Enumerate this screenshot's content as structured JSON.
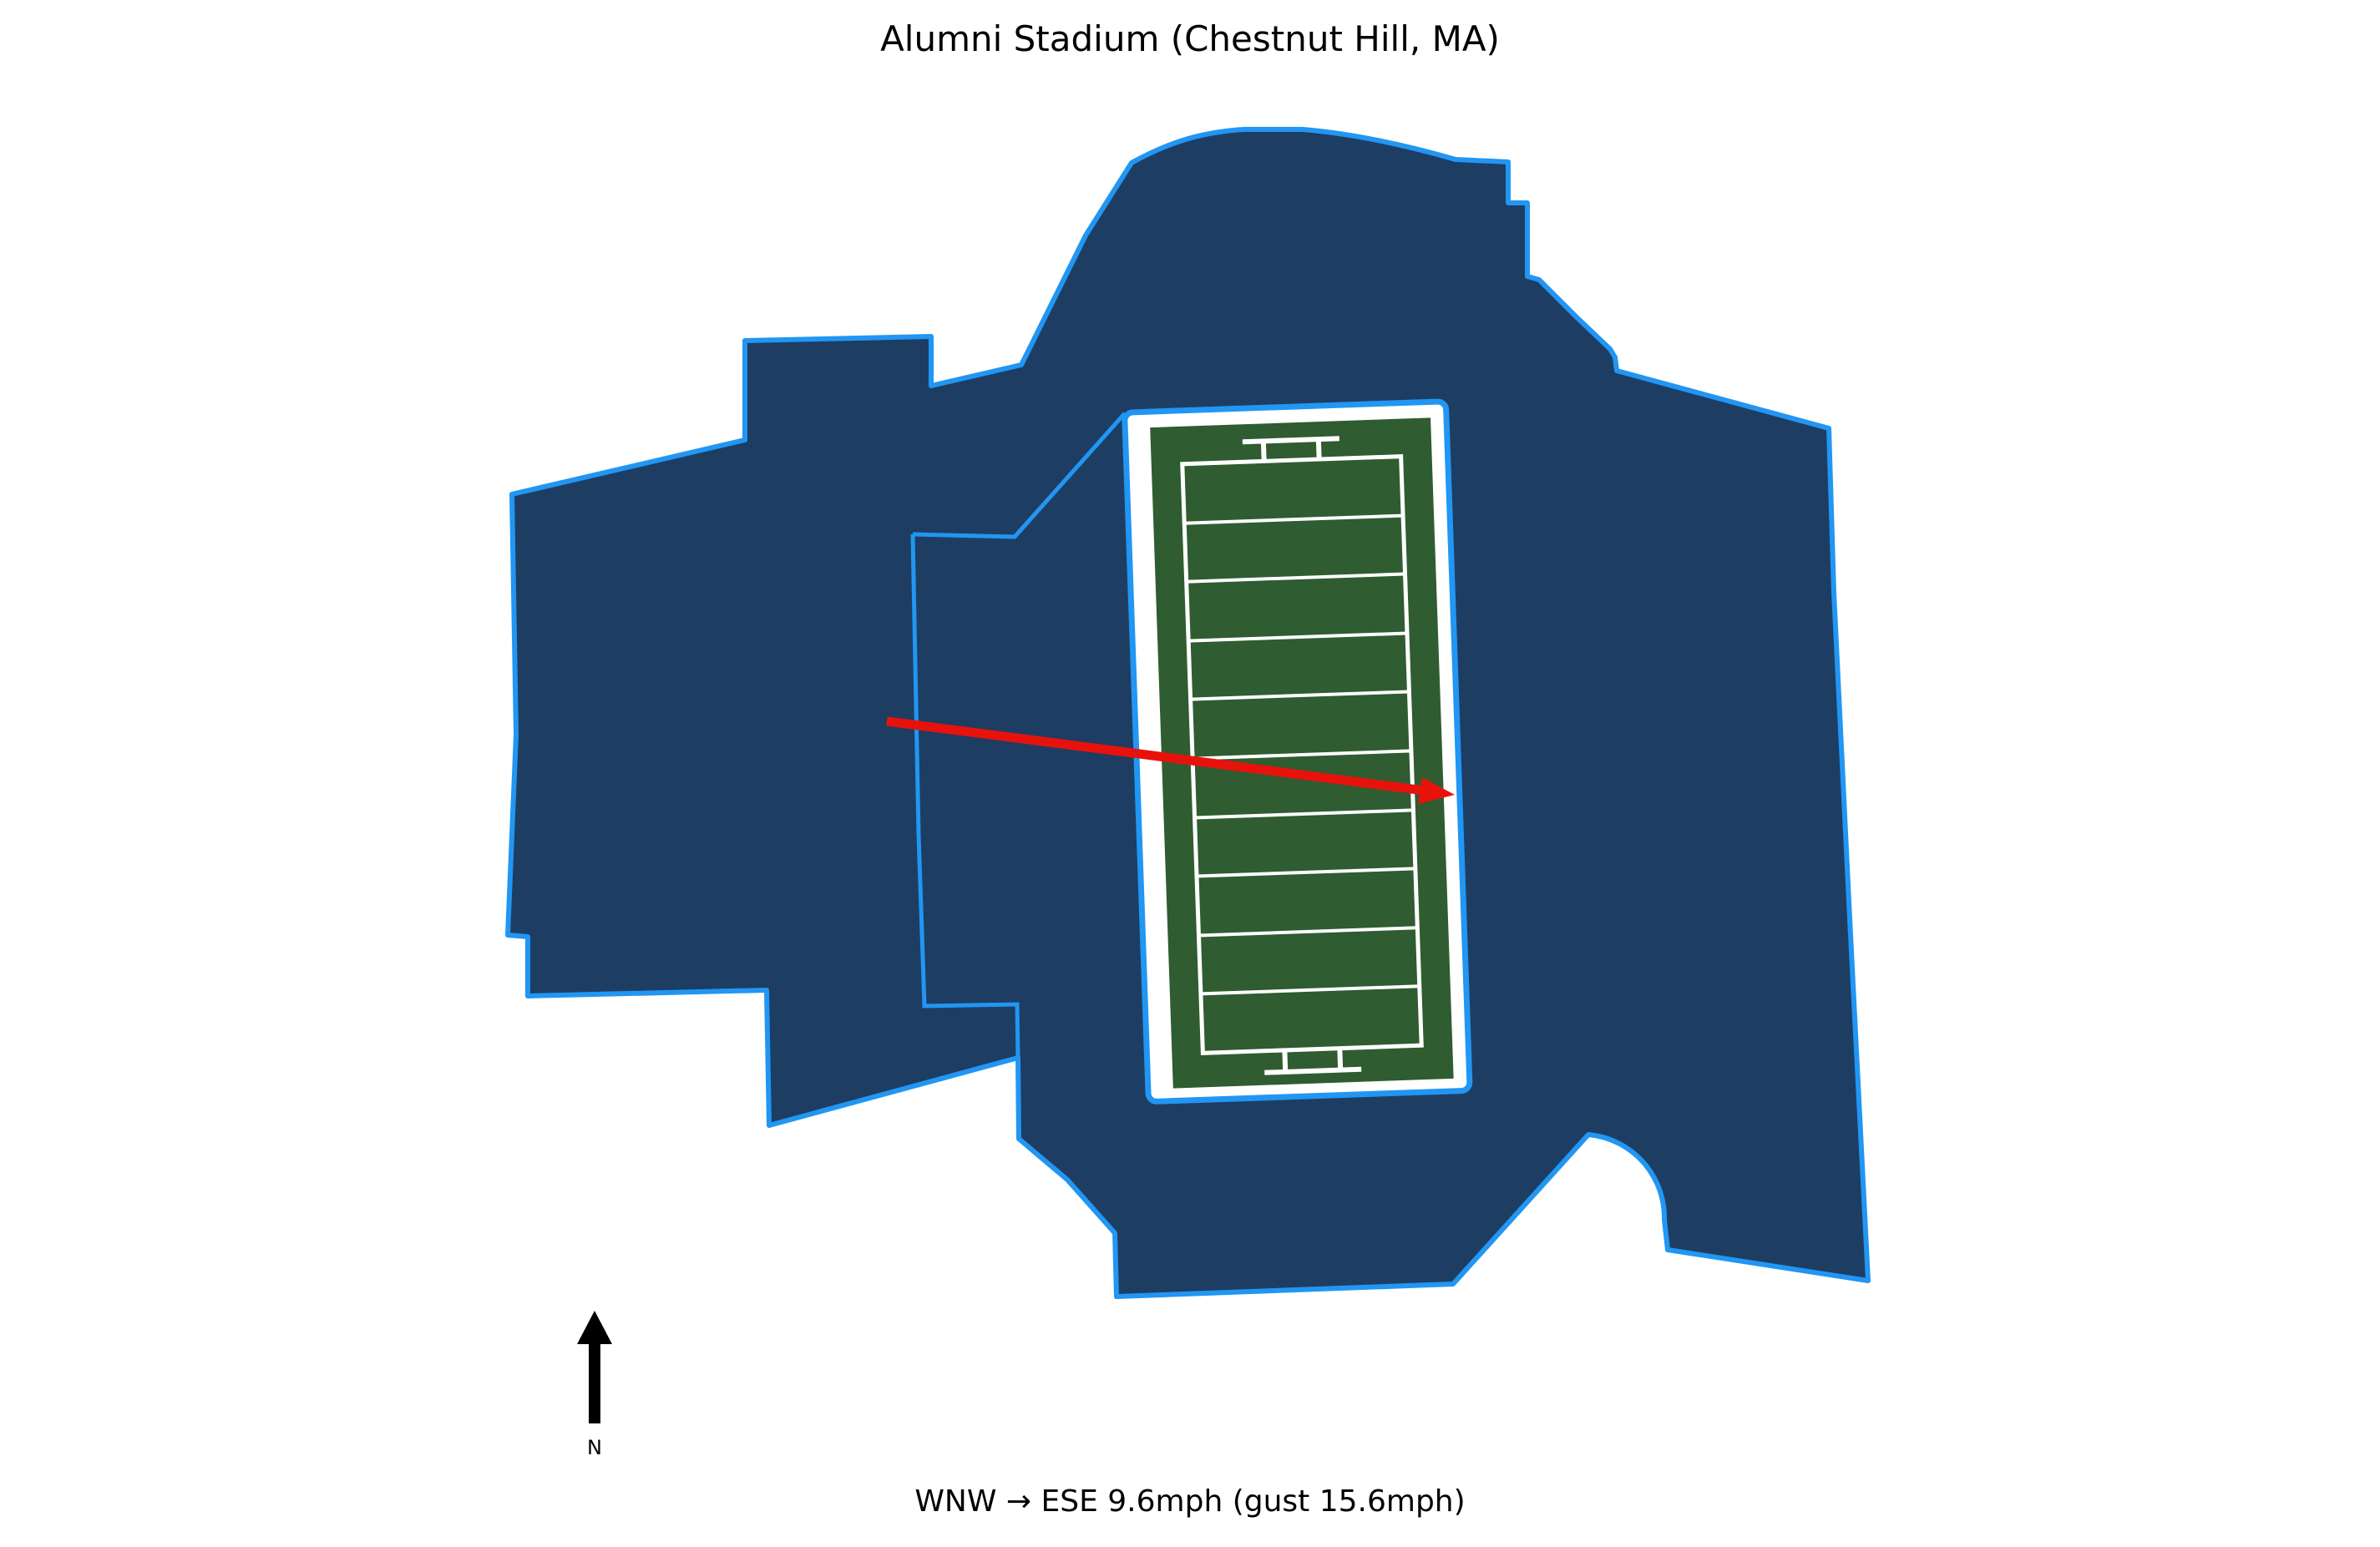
{
  "title": {
    "text": "Alumni Stadium (Chestnut Hill, MA)"
  },
  "caption": {
    "text": "WNW → ESE 9.6mph (gust 15.6mph)",
    "wind_from": "WNW",
    "wind_to": "ESE",
    "wind_speed_mph": 9.6,
    "wind_gust_mph": 15.6
  },
  "compass": {
    "label": "N"
  },
  "colors": {
    "background": "#ffffff",
    "stadium_fill": "#1e3d63",
    "stadium_stroke": "#2196f3",
    "field_green": "#2f5c30",
    "field_surround": "#ffffff",
    "field_lines": "#ffffff",
    "wind_arrow": "#e8120c",
    "north_arrow": "#000000",
    "text": "#000000"
  },
  "field": {
    "yard_line_count": 9,
    "segments_between_goal_lines": 10
  }
}
